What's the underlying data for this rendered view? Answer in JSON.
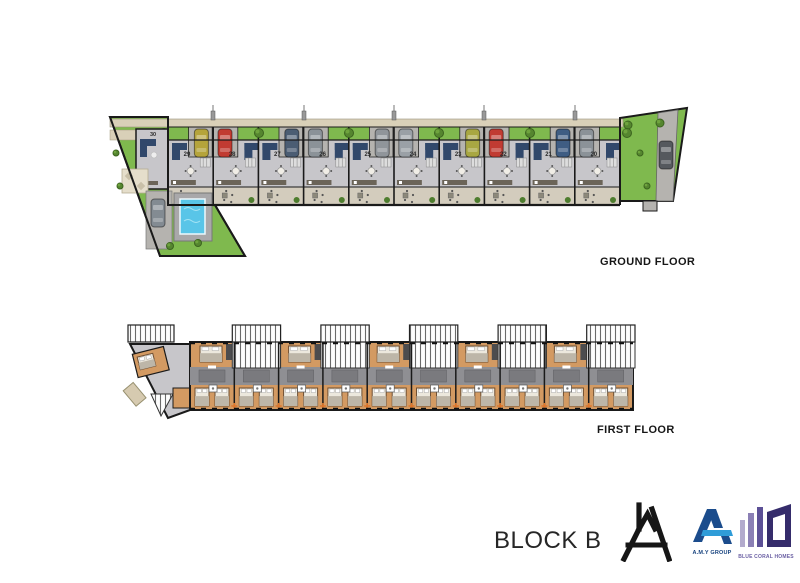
{
  "ground_floor": {
    "label": "GROUND FLOOR",
    "wedge_unit": {
      "number": "30"
    },
    "units": [
      {
        "number": "29",
        "car_color": "#b5a43b",
        "car_side": "right"
      },
      {
        "number": "28",
        "car_color": "#c13b32",
        "car_side": "left"
      },
      {
        "number": "27",
        "car_color": "#4b5d73",
        "car_side": "right"
      },
      {
        "number": "26",
        "car_color": "#8b9298",
        "car_side": "left"
      },
      {
        "number": "25",
        "car_color": "#90959a",
        "car_side": "right"
      },
      {
        "number": "24",
        "car_color": "#9aa0a6",
        "car_side": "left"
      },
      {
        "number": "23",
        "car_color": "#a8a742",
        "car_side": "right"
      },
      {
        "number": "22",
        "car_color": "#c13b32",
        "car_side": "left"
      },
      {
        "number": "21",
        "car_color": "#3f5d83",
        "car_side": "right"
      },
      {
        "number": "20",
        "car_color": "#8b9298",
        "car_side": "left"
      }
    ],
    "end_cars": [
      {
        "location": "left-driveway",
        "color": "#838b92"
      },
      {
        "location": "right-driveway",
        "color": "#55595e"
      }
    ]
  },
  "first_floor": {
    "label": "FIRST FLOOR",
    "unit_count": 11,
    "roof_terrace_count": 6
  },
  "footer": {
    "block_label": "BLOCK B"
  },
  "logos": {
    "architect_monogram": {
      "name": "house-a-monogram",
      "color": "#161616"
    },
    "amy_group": {
      "label": "A.M.Y GROUP",
      "primary": "#1b4c8c",
      "accent": "#2f9cd8"
    },
    "blue_coral": {
      "label": "BLUE CORAL HOMES",
      "bar_colors": [
        "#b3abcd",
        "#8b80b5",
        "#5c5096"
      ],
      "frame_color": "#352c6b",
      "text_color": "#6a5fa3"
    }
  },
  "palette": {
    "wall": "#1a1a1a",
    "green": "#7fb94e",
    "green_dark": "#4e7d2e",
    "beige": "#d9d0b8",
    "pave": "#b5b3af",
    "floor": "#c7c6ca",
    "patio": "#d3ccbd",
    "navy": "#31486b",
    "pool": "#59c5e8",
    "pool_deck": "#a9a8aa",
    "room_orange": "#d39a62",
    "bed_frame": "#6e4f33",
    "bed_light": "#ece8dd",
    "blanket": "#bdb6a8",
    "corridor": "#8f8f93",
    "corridor_dark": "#7a7a7e",
    "counter": "#6b6458",
    "accent_orange": "#e0762a",
    "label": "#2a2a2a"
  }
}
